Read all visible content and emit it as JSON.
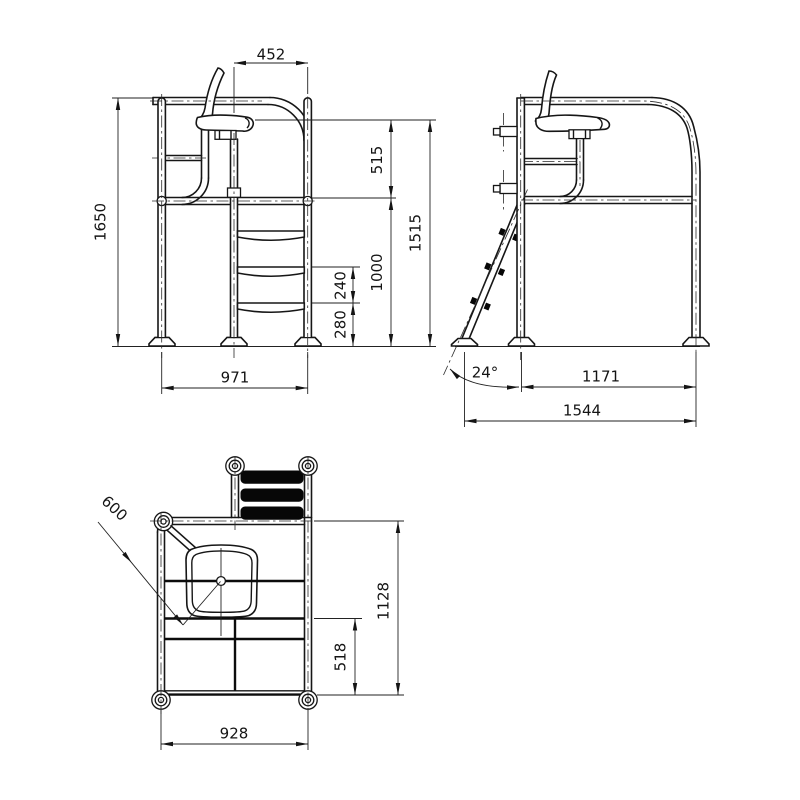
{
  "drawing": {
    "type": "lifeguard-chair-orthographic-drawing",
    "background": "#ffffff",
    "line_color": "#161616",
    "views": [
      "front-elevation",
      "side-elevation",
      "plan-view"
    ]
  },
  "dims": {
    "front": {
      "seat_width": "452",
      "seat_to_platform": "515",
      "platform_height": "1000",
      "seat_height": "1515",
      "frame_height": "1650",
      "rung_spacing": "240",
      "bottom_rung_height": "280",
      "base_width": "971"
    },
    "side": {
      "ladder_angle": "24°",
      "leg_span": "1171",
      "overall_depth": "1544"
    },
    "plan": {
      "seat_diagonal": "600",
      "overall_depth": "1128",
      "rear_depth": "518",
      "base_width": "928"
    }
  }
}
